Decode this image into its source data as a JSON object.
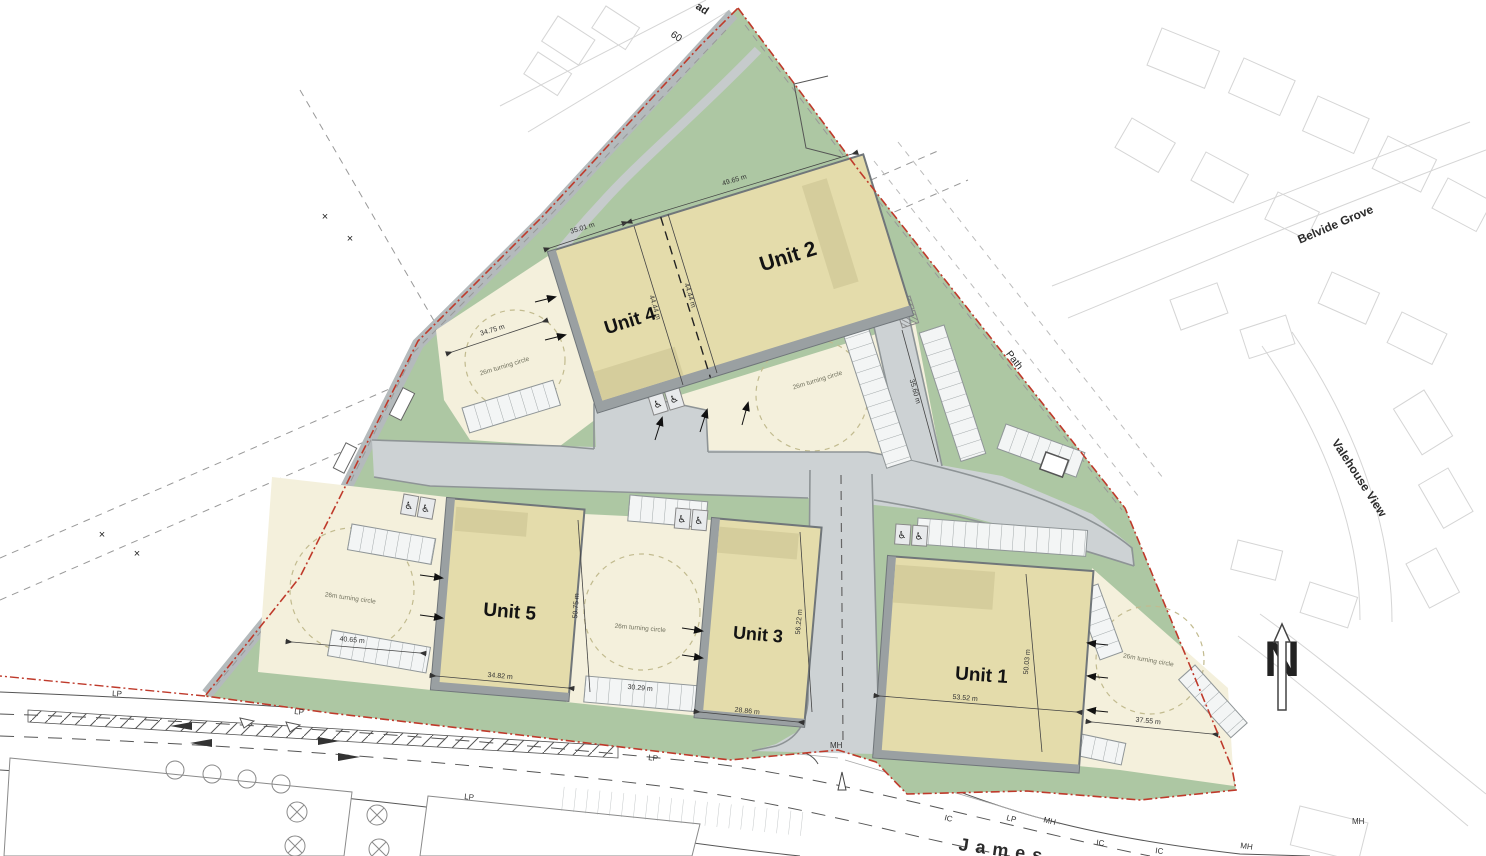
{
  "plan": {
    "units": [
      {
        "name": "Unit 1",
        "dim_w": "53.52 m",
        "dim_h": "50.03 m",
        "yard_dim": "37.55 m"
      },
      {
        "name": "Unit 2",
        "dim_w": "49.65 m",
        "dim_h": "44.44 m",
        "yard_dim": "35.60 m"
      },
      {
        "name": "Unit 3",
        "dim_w": "28.86 m",
        "dim_h": "56.22 m",
        "yard_dim": "30.29 m"
      },
      {
        "name": "Unit 4",
        "dim_w": "35.01 m",
        "dim_h": "44.44 m",
        "yard_dim": "34.75 m"
      },
      {
        "name": "Unit 5",
        "dim_w": "34.82 m",
        "dim_h": "50.75 m",
        "yard_dim": "40.65 m"
      }
    ],
    "turning_circle_label": "26m turning circle",
    "streets": {
      "belvide_grove": "Belvide Grove",
      "valehouse_view": "Valehouse View",
      "path": "Path",
      "james": "James",
      "top_road_fragment": "ad",
      "house_number": "60"
    },
    "utility_markers": {
      "lp": "LP",
      "mh": "MH",
      "ic": "IC"
    },
    "north_letter": "N",
    "colors": {
      "boundary_red": "#bf3a2b",
      "landscape_green": "#adc7a3",
      "road_grey": "#cdd2d4",
      "kerb_grey": "#8e9496",
      "unit_beige": "#e4dcab",
      "unit_canopy": "#d5cd9c",
      "yard_cream": "#f4f0dc",
      "context_grey": "#d5d5d5"
    }
  }
}
